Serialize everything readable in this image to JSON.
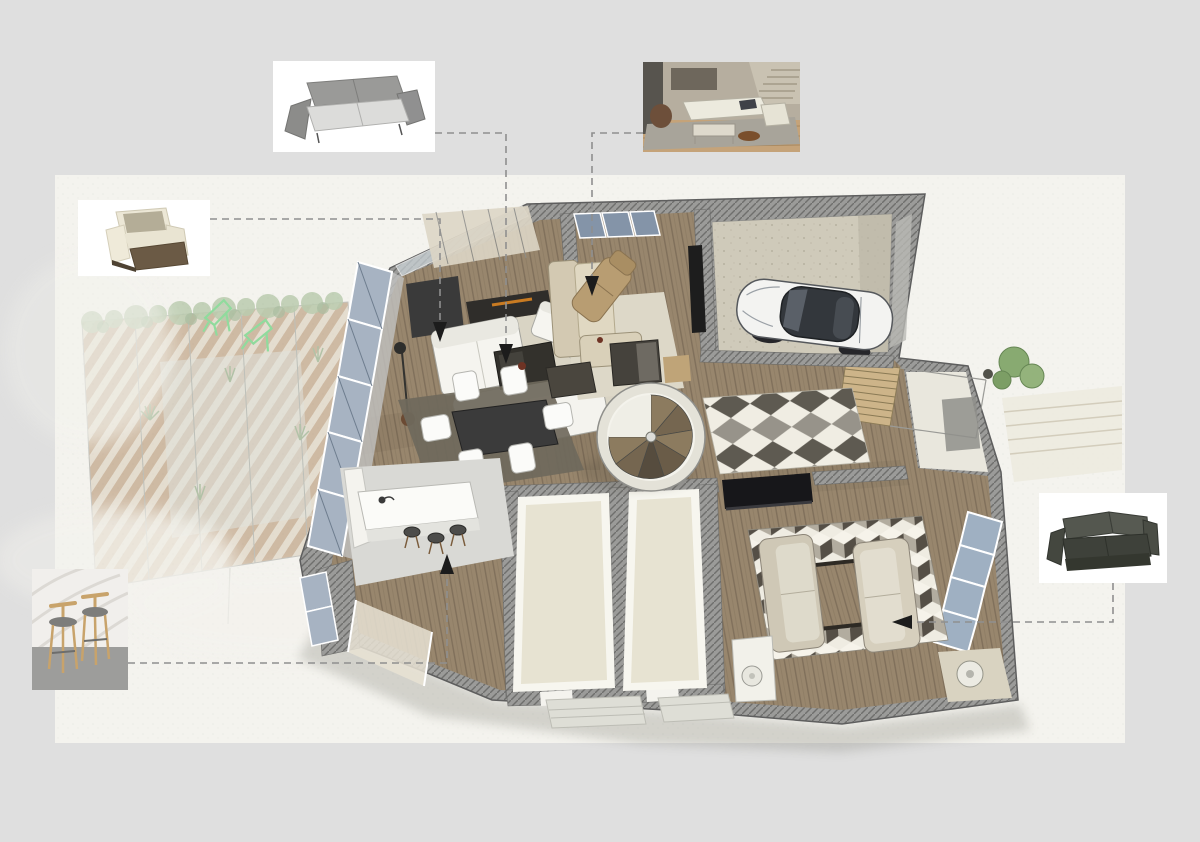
{
  "page": {
    "background_color": "#dfdfdf",
    "panel_color": "#f4f3ee",
    "leader_line_color": "#8f8f8f",
    "arrow_color": "#1c1c1c"
  },
  "presentation": {
    "type": "interior-design-floor-plan-visualization",
    "floor_plan": {
      "style": "3d-cutaway-axonometric-render",
      "rooms": [
        {
          "name": "living-room",
          "furniture": [
            "white-sofa",
            "white-loveseat",
            "two-white-armchairs",
            "fireplace",
            "dark-coffee-table",
            "floor-lamp",
            "cream-rug"
          ]
        },
        {
          "name": "family-lounge",
          "furniture": [
            "beige-sectional-sofa",
            "tan-lounge-chair",
            "dark-coffee-table",
            "wall-tv"
          ]
        },
        {
          "name": "garage",
          "furniture": [
            "white-sports-car"
          ]
        },
        {
          "name": "hallway",
          "furniture": [
            "spiral-staircase",
            "diamond-pattern-runner-rug"
          ]
        },
        {
          "name": "dining-area",
          "furniture": [
            "dark-dining-table",
            "six-white-chairs",
            "grey-rug",
            "sideboard"
          ]
        },
        {
          "name": "kitchen",
          "furniture": [
            "white-island-counter",
            "bar-stools",
            "sink-faucet",
            "cabinets"
          ]
        },
        {
          "name": "empty-room-1",
          "furniture": []
        },
        {
          "name": "empty-room-2",
          "furniture": []
        },
        {
          "name": "tv-lounge",
          "furniture": [
            "beige-sofa-left",
            "beige-sofa-right",
            "wood-coffee-table",
            "cube-pattern-rug",
            "tv-console"
          ]
        },
        {
          "name": "exterior-stair",
          "furniture": [
            "wooden-steps",
            "railing"
          ]
        }
      ],
      "surroundings": [
        "pergola-terrace",
        "garden-planting",
        "green-deck-chairs",
        "paved-patio",
        "bushes"
      ]
    },
    "callouts": [
      {
        "id": "grey-sofa-card",
        "item": "grey-fabric-sofa",
        "links_to": "living-room"
      },
      {
        "id": "interior-photo-card",
        "item": "white-sectional-sofa-interior-photo",
        "links_to": "family-lounge"
      },
      {
        "id": "armchair-card",
        "item": "cream-armchair",
        "links_to": "living-room"
      },
      {
        "id": "bar-stools-card",
        "item": "wooden-bar-stools-photo",
        "links_to": "kitchen"
      },
      {
        "id": "dark-sofa-card",
        "item": "charcoal-leather-sofa",
        "links_to": "tv-lounge"
      }
    ],
    "leader_line_count": 5,
    "colors": {
      "wall_hatch": "#9b9b99",
      "wood_floor": "#98866d",
      "glass": "#a7b3c2",
      "rug_cream": "#d9d4c4",
      "rug_dark": "#6f695c",
      "car_body": "#f3f3f1"
    }
  }
}
